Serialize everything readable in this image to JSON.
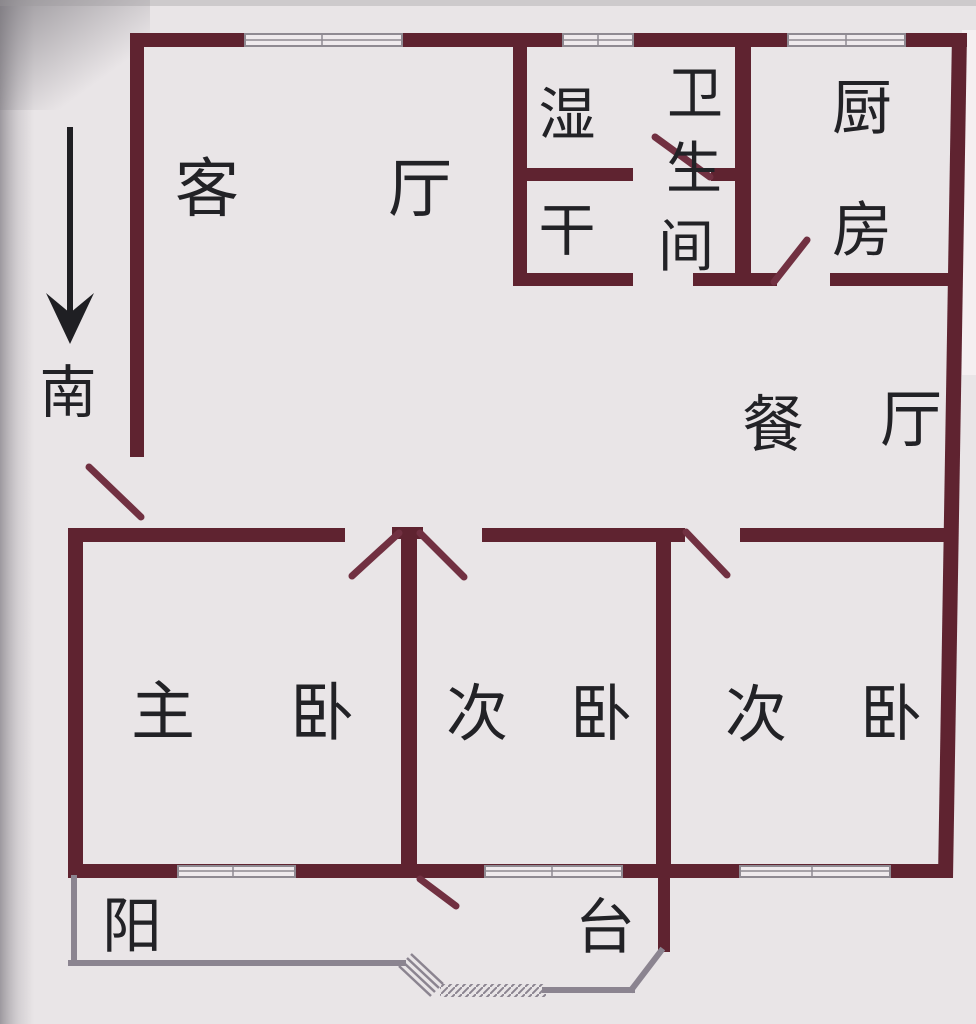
{
  "compass": {
    "label": "南",
    "direction": "down"
  },
  "rooms": [
    {
      "name": "living-room",
      "label": "客 厅"
    },
    {
      "name": "wet-area",
      "label": "湿"
    },
    {
      "name": "dry-area",
      "label": "干"
    },
    {
      "name": "bathroom",
      "label": "卫生间"
    },
    {
      "name": "kitchen",
      "label": "厨房"
    },
    {
      "name": "dining-room",
      "label": "餐 厅"
    },
    {
      "name": "master-bedroom",
      "label": "主 卧"
    },
    {
      "name": "second-bedroom",
      "label": "次 卧"
    },
    {
      "name": "third-bedroom",
      "label": "次 卧"
    },
    {
      "name": "balcony",
      "label": "阳 台"
    }
  ],
  "labels": {
    "living_1": "客",
    "living_2": "厅",
    "wet": "湿",
    "dry": "干",
    "bath_1": "卫",
    "bath_2": "生",
    "bath_3": "间",
    "kitchen_1": "厨",
    "kitchen_2": "房",
    "dining_1": "餐",
    "dining_2": "厅",
    "master_1": "主",
    "master_2": "卧",
    "bed2_1": "次",
    "bed2_2": "卧",
    "bed3_1": "次",
    "bed3_2": "卧",
    "balcony_1": "阳",
    "balcony_2": "台",
    "south": "南"
  },
  "colors": {
    "bg": "#e9e5e7",
    "wall": "#5f2330",
    "door": "#713041",
    "balcony_rail": "#8b8490",
    "window_fill": "#efeaed",
    "window_frame": "#8f8a92",
    "text": "#222226",
    "arrow": "#1f1f23"
  }
}
